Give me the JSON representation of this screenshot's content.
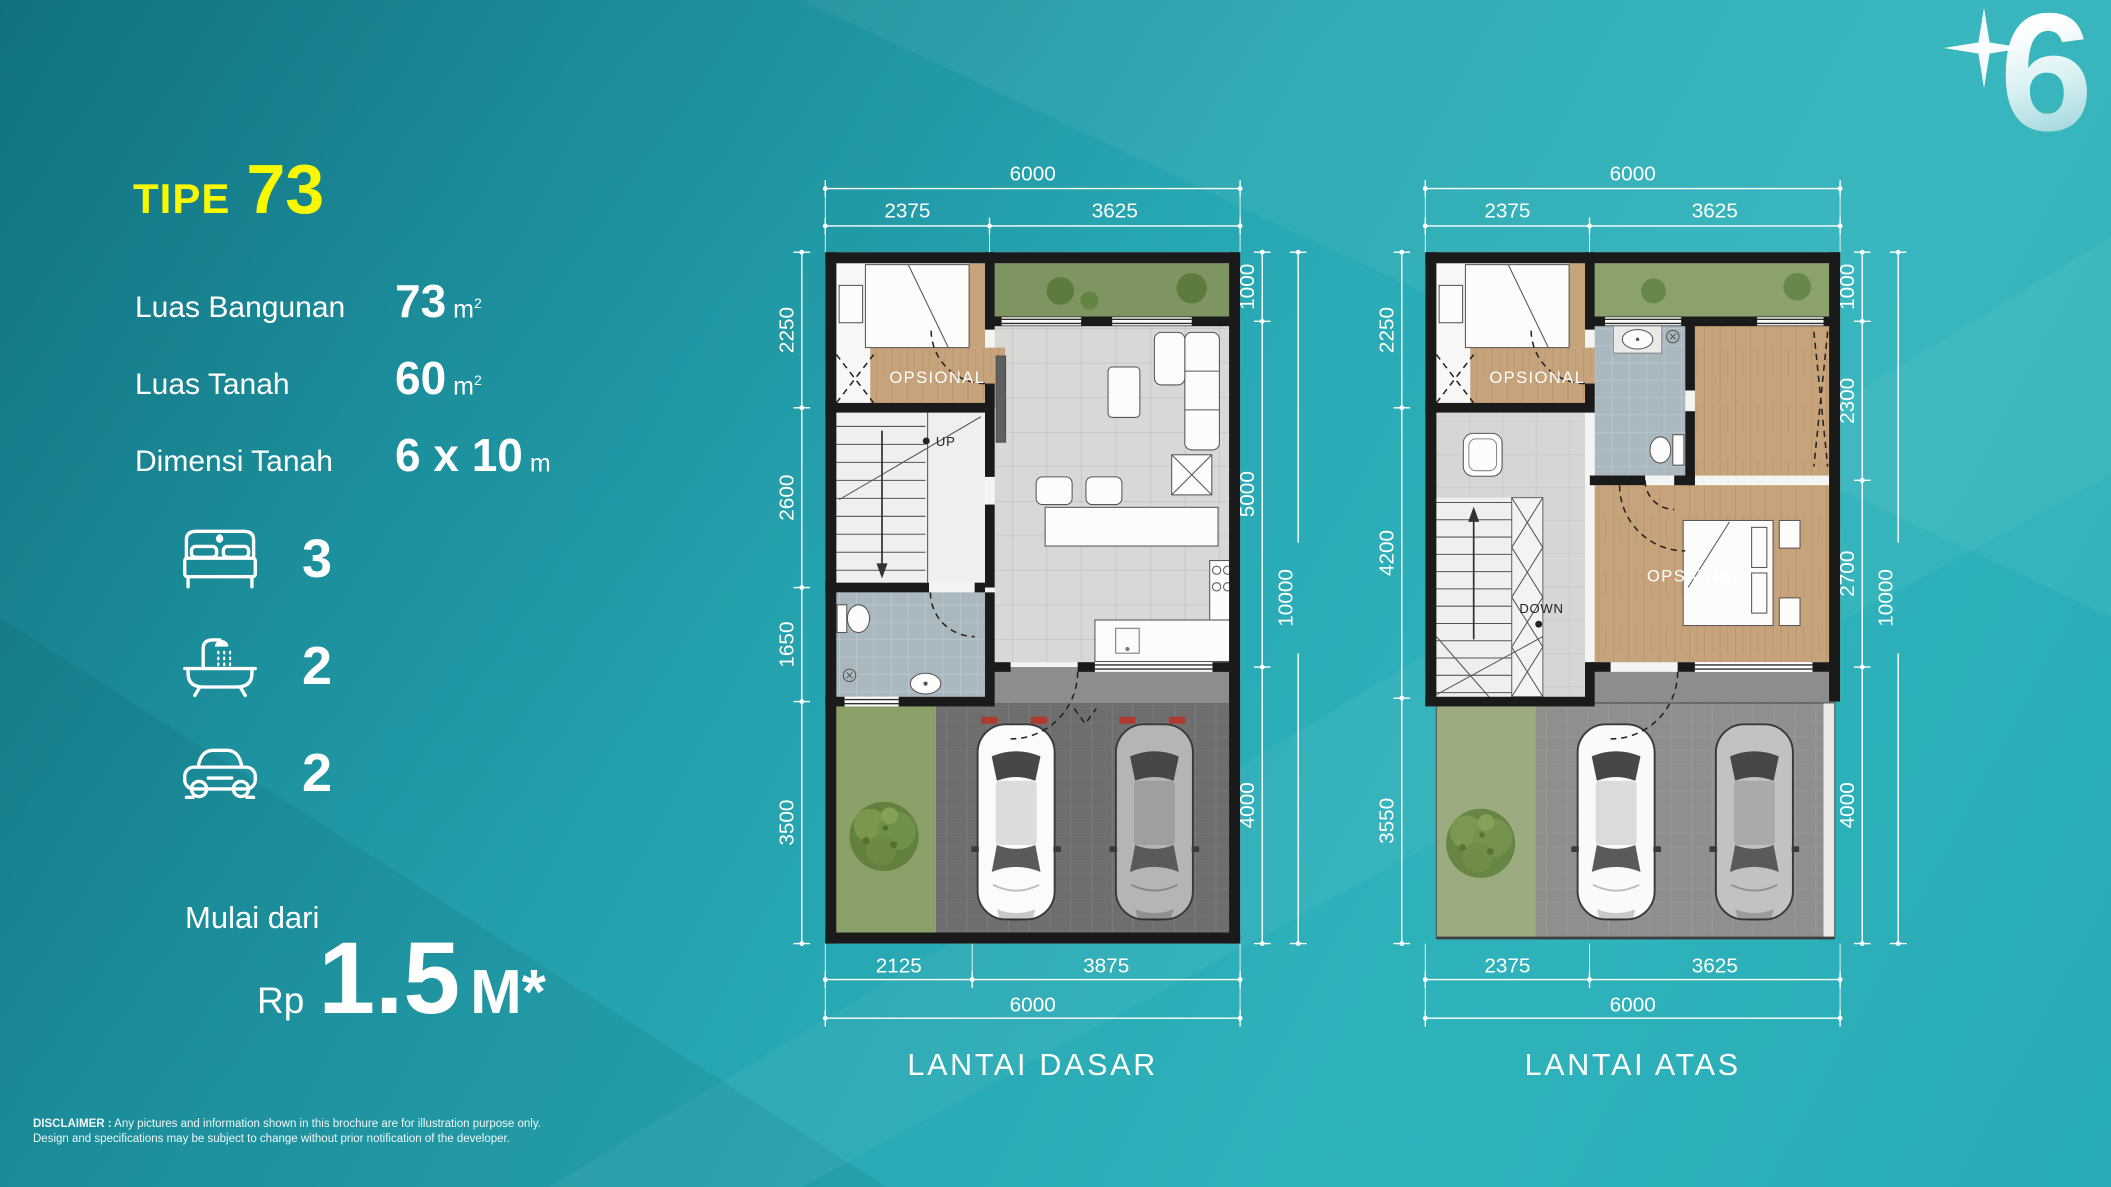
{
  "logo": {
    "number": "6"
  },
  "panel": {
    "type_label": "TIPE",
    "type_number": "73",
    "specs": [
      {
        "label": "Luas Bangunan",
        "value": "73",
        "unit": "m",
        "sup": "2"
      },
      {
        "label": "Luas Tanah",
        "value": "60",
        "unit": "m",
        "sup": "2"
      },
      {
        "label": "Dimensi Tanah",
        "value": "6 x 10",
        "unit": "m",
        "sup": ""
      }
    ],
    "features": [
      {
        "icon": "bed-icon",
        "count": "3"
      },
      {
        "icon": "bath-icon",
        "count": "2"
      },
      {
        "icon": "car-icon",
        "count": "2"
      }
    ],
    "price": {
      "prefix": "Mulai dari",
      "currency": "Rp",
      "amount": "1.5",
      "suffix": "M*"
    }
  },
  "plans": [
    {
      "name": "LANTAI DASAR",
      "dims": {
        "top_total": "6000",
        "top_segments": [
          "2375",
          "3625"
        ],
        "left_segments": [
          "2250",
          "2600",
          "1650",
          "3500"
        ],
        "right_segments": [
          "1000",
          "5000",
          "4000"
        ],
        "right_total": "10000",
        "bottom_segments": [
          "2125",
          "3875"
        ],
        "bottom_total": "6000"
      },
      "labels": {
        "opsional": "OPSIONAL",
        "stair": "UP"
      }
    },
    {
      "name": "LANTAI ATAS",
      "dims": {
        "top_total": "6000",
        "top_segments": [
          "2375",
          "3625"
        ],
        "left_segments": [
          "2250",
          "4200",
          "3550"
        ],
        "right_segments": [
          "1000",
          "2300",
          "2700",
          "4000"
        ],
        "right_total": "10000",
        "bottom_segments": [
          "2375",
          "3625"
        ],
        "bottom_total": "6000"
      },
      "labels": {
        "opsional1": "OPSIONAL",
        "opsional2": "OPSIONAL",
        "stair": "DOWN"
      }
    }
  ],
  "footer": {
    "disclaimer_label": "DISCLAIMER :",
    "line1": "Any pictures and information shown in this brochure are for illustration purpose only.",
    "line2": "Design and specifications may be subject to change without prior notification of the developer."
  },
  "colors": {
    "background_teal": "#27a7b2",
    "accent_yellow": "#f8f800",
    "wall_black": "#1a1a1a",
    "wood": "#c7a37c",
    "garden_green": "#7e9562",
    "bath_blue": "#a9b8bf"
  }
}
